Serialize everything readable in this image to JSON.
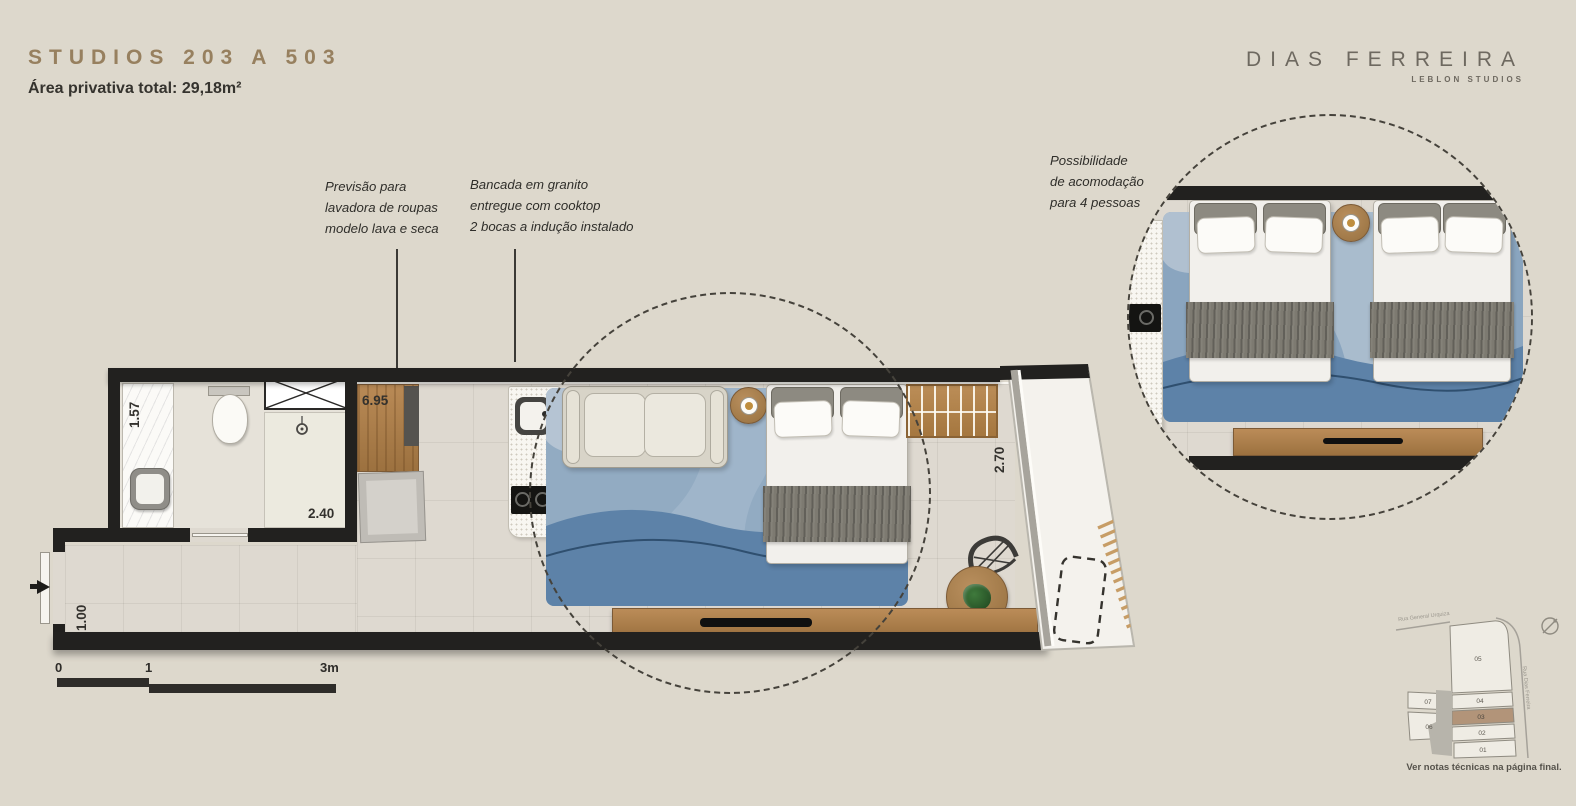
{
  "theme": {
    "background": "#ddd8cc",
    "title_color": "#97805f",
    "text_dark": "#35332e",
    "brand_color": "#6e6960",
    "wall_color": "#22211f",
    "wood": "#a87c4e",
    "unit_highlight": "#b29479"
  },
  "header": {
    "title": "STUDIOS 203 A 503",
    "area": "Área privativa total: 29,18m²"
  },
  "brand": {
    "name": "DIAS FERREIRA",
    "tagline": "LEBLON STUDIOS"
  },
  "annotations": {
    "washer": {
      "lines": [
        "Previsão para",
        "lavadora de roupas",
        "modelo lava e seca"
      ]
    },
    "counter": {
      "lines": [
        "Bancada em granito",
        "entregue com cooktop",
        "2 bocas a indução instalado"
      ]
    },
    "occupancy": {
      "lines": [
        "Possibilidade",
        "de acomodação",
        "para 4 pessoas"
      ]
    }
  },
  "plan": {
    "dimensions": {
      "bath": "1.57",
      "shower": "2.40",
      "living": "6.95",
      "entry": "1.00",
      "balcony": "2.70"
    }
  },
  "scalebar": {
    "zero": "0",
    "one": "1",
    "three": "3m"
  },
  "sitemap": {
    "streets": {
      "top": "Rua General Urquiza",
      "right": "Rua Dias Ferreira"
    },
    "units": {
      "u01": "01",
      "u02": "02",
      "u03": "03",
      "u04": "04",
      "u05": "05",
      "u06": "06",
      "u07": "07"
    },
    "note": "Ver notas técnicas na página final."
  }
}
